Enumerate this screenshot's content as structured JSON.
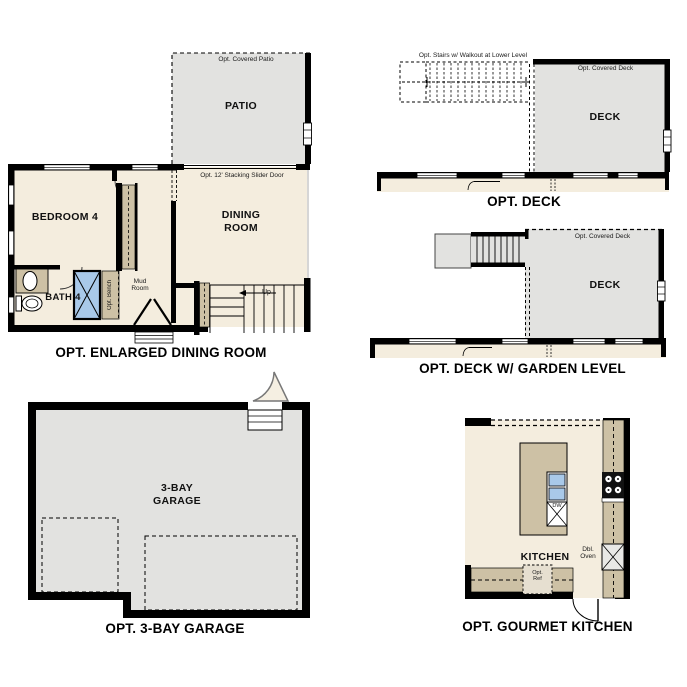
{
  "sheet": {
    "background": "#ffffff",
    "description": "Floor plan options sheet"
  },
  "colors": {
    "wall": "#000000",
    "floor_beige": "#f4edde",
    "hardscape_gray": "#e2e2e0",
    "counter_tan": "#cdc1a5",
    "fixture_blue": "#a9c9e9",
    "appliance_black": "#111111",
    "door_leaf_cream": "#f5efe2"
  },
  "figures": {
    "enlarged_dining": {
      "title": "OPT. ENLARGED DINING ROOM",
      "labels": {
        "covered_patio": "Opt. Covered Patio",
        "patio": "PATIO",
        "slider_door": "Opt. 12' Stacking Slider Door",
        "bedroom": "BEDROOM 4",
        "dining": "DINING ROOM",
        "bath": "BATH 4",
        "bench": "Opt. Bench",
        "mud_room": "Mud Room",
        "up": "Up"
      }
    },
    "deck": {
      "title": "OPT. DECK",
      "labels": {
        "stairs": "Opt. Stairs w/ Walkout at Lower Level",
        "covered_deck": "Opt. Covered Deck",
        "deck": "DECK"
      }
    },
    "deck_garden": {
      "title": "OPT. DECK W/ GARDEN LEVEL",
      "labels": {
        "covered_deck": "Opt. Covered Deck",
        "deck": "DECK"
      }
    },
    "garage": {
      "title": "OPT. 3-BAY GARAGE",
      "labels": {
        "garage": "3-BAY GARAGE"
      }
    },
    "kitchen": {
      "title": "OPT. GOURMET KITCHEN",
      "labels": {
        "kitchen": "KITCHEN",
        "dw": "DW",
        "dbl_oven": "Dbl. Oven",
        "opt_ref": "Opt. Ref"
      }
    }
  }
}
